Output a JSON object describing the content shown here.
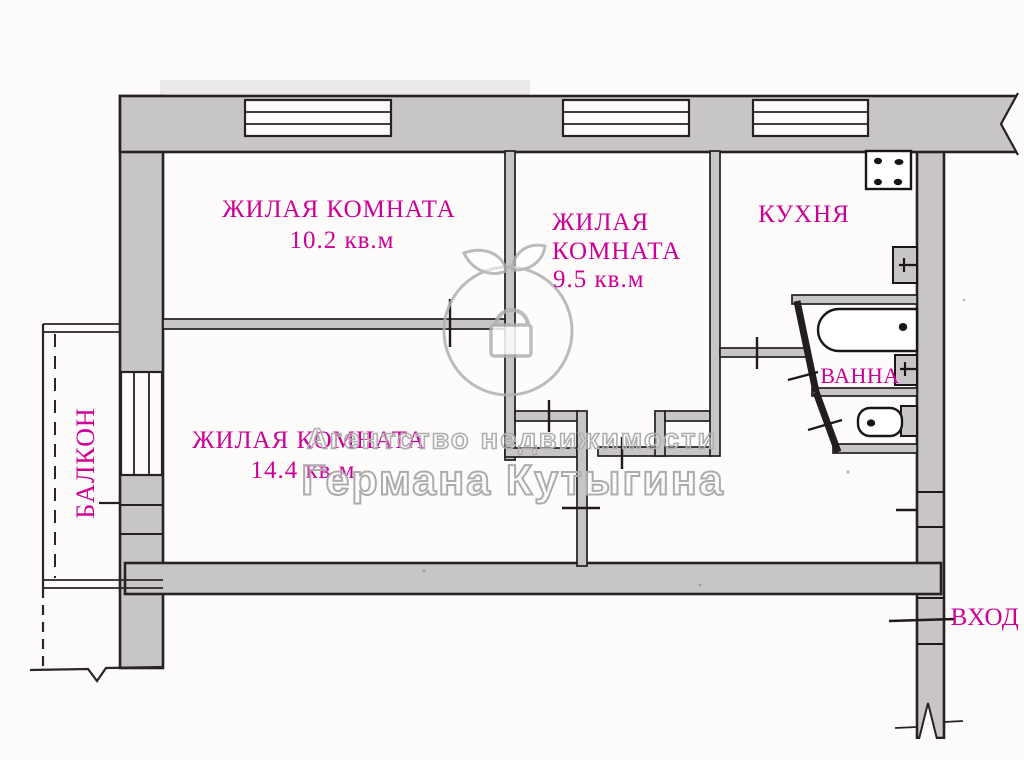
{
  "plan": {
    "title": "apartment-floor-plan",
    "rooms": [
      {
        "id": "room-10-2",
        "name": "ЖИЛАЯ КОМНАТА",
        "area": "10.2 кв.м"
      },
      {
        "id": "room-9-5",
        "name_line1": "ЖИЛАЯ",
        "name_line2": "КОМНАТА",
        "area": "9.5 кв.м"
      },
      {
        "id": "room-14-4",
        "name": "ЖИЛАЯ КОМНАТА",
        "area": "14.4 кв.м"
      },
      {
        "id": "kitchen",
        "name": "КУХНЯ"
      },
      {
        "id": "bathroom",
        "name": "ВАННА"
      },
      {
        "id": "balcony",
        "name": "БАЛКОН"
      },
      {
        "id": "entrance",
        "name": "ВХОД"
      }
    ],
    "fixtures": [
      "stove-icon",
      "kitchen-sink-icon",
      "bathtub-icon",
      "bath-sink-icon",
      "toilet-icon"
    ],
    "windows_count": 4,
    "doors_count": 10
  },
  "watermark": {
    "line1": "Агентство недвижимости",
    "line2": "Германа Кутыгина",
    "logo": "apple-with-lock-logo"
  },
  "colors": {
    "label_magenta": "#cc0099",
    "wall_fill": "#c8c5c6",
    "wall_line": "#262222",
    "watermark_gray": "#b0adad",
    "background": "#fdfcfb"
  }
}
